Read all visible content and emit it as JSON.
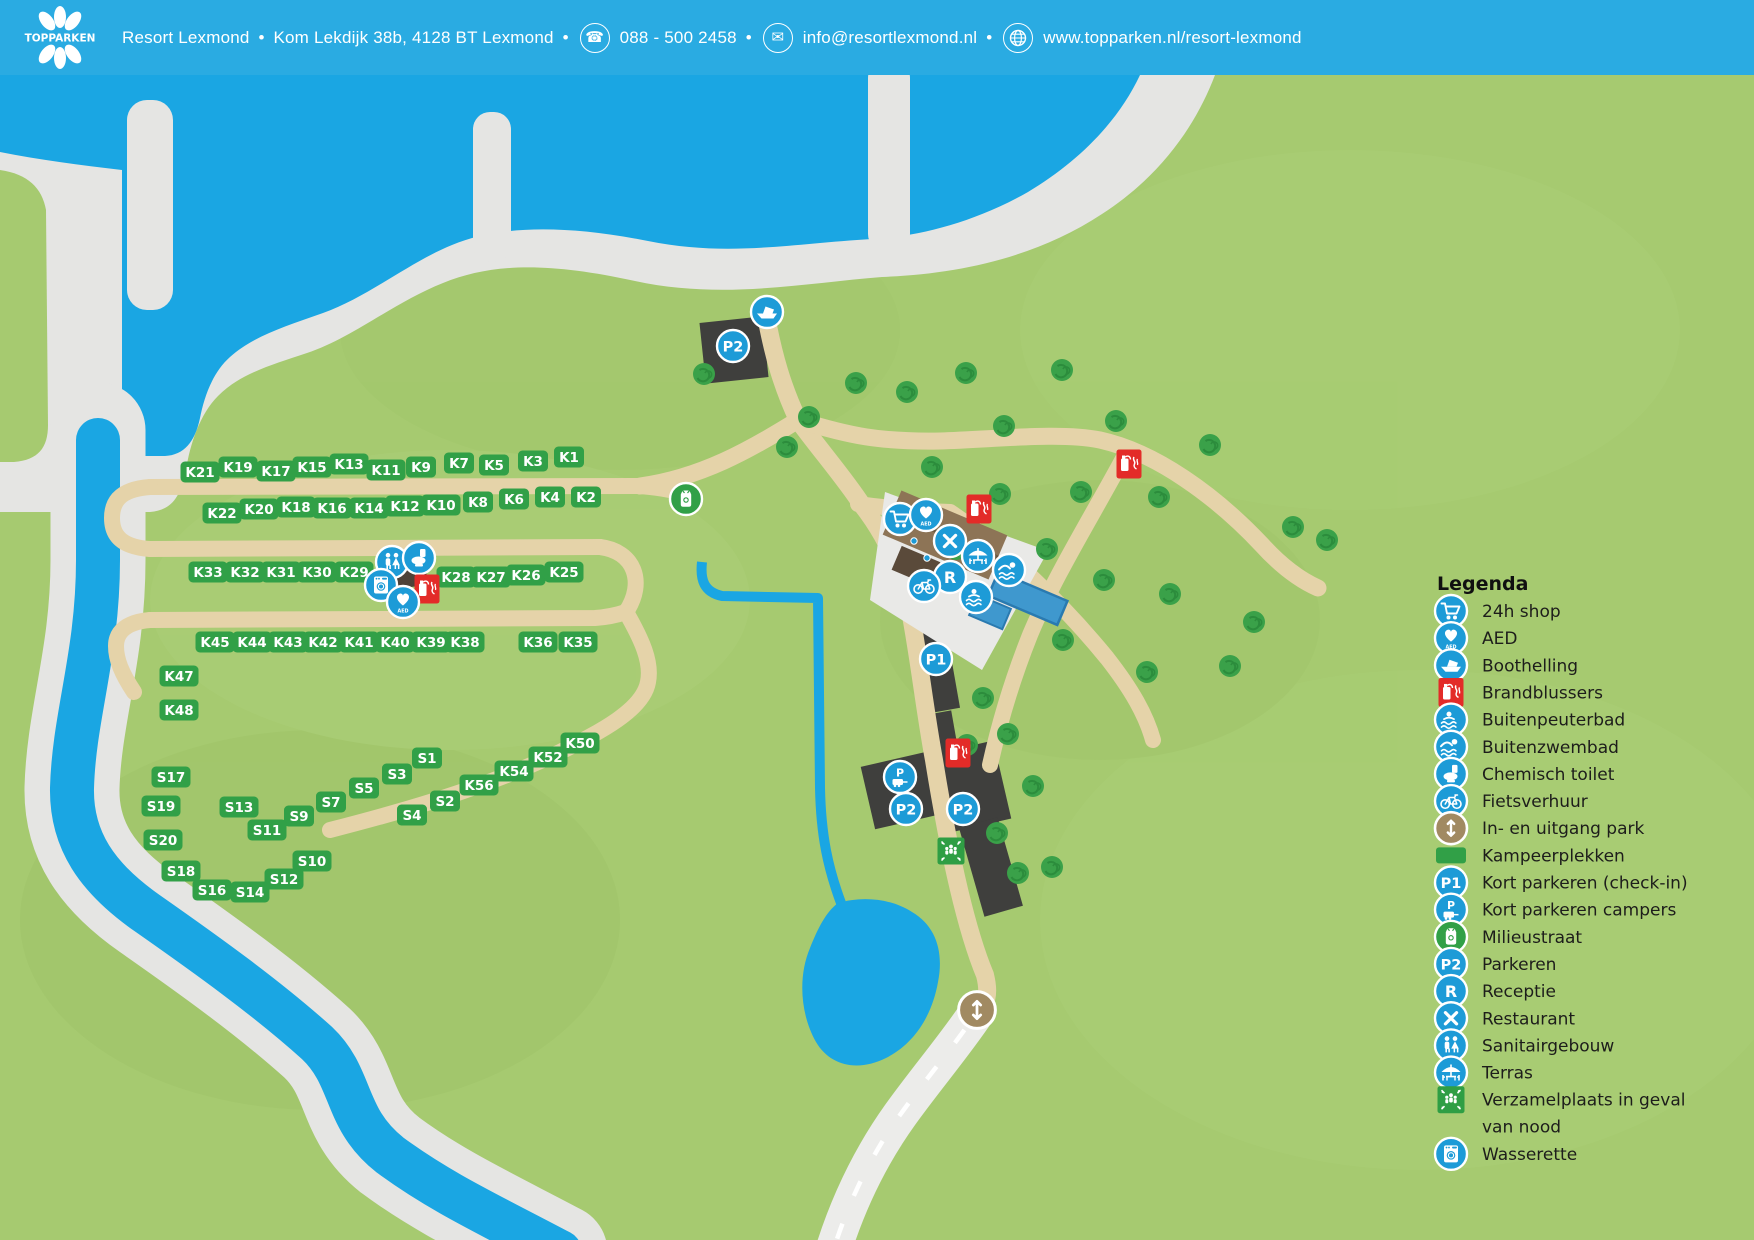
{
  "header": {
    "logo_text": "TOPPARKEN",
    "resort_name": "Resort Lexmond",
    "address": "Kom Lekdijk 38b, 4128 BT Lexmond",
    "separator": "•",
    "phone": "088 - 500 2458",
    "email": "info@resortlexmond.nl",
    "website": "www.topparken.nl/resort-lexmond",
    "glyphs": {
      "phone": "☎",
      "mail": "✉"
    }
  },
  "colors": {
    "header_bg": "#2aabe2",
    "grass": "#a6ca70",
    "water": "#1aa6e3",
    "sand": "#e5e5e3",
    "road": "#e5d3a9",
    "parking_dark": "#3f3f3d",
    "label_green": "#31a047",
    "icon_blue": "#1d9bd7",
    "icon_red": "#e32b28",
    "icon_green": "#31a047",
    "entrance_brown": "#a18a62",
    "plaza": "#e9e9e7",
    "building": "#8d7456",
    "pool": "#3f98ce",
    "white_road": "#ececea",
    "tree": "#3aa149"
  },
  "legend": {
    "title": "Legenda",
    "items": [
      {
        "icon": "shop",
        "label": "24h shop"
      },
      {
        "icon": "aed",
        "label": "AED"
      },
      {
        "icon": "boothelling",
        "label": "Boothelling"
      },
      {
        "icon": "brandblussers",
        "label": "Brandblussers"
      },
      {
        "icon": "peuterbad",
        "label": "Buitenpeuterbad"
      },
      {
        "icon": "zwembad",
        "label": "Buitenzwembad"
      },
      {
        "icon": "chemisch",
        "label": "Chemisch toilet"
      },
      {
        "icon": "fiets",
        "label": "Fietsverhuur"
      },
      {
        "icon": "entrance",
        "label": "In- en uitgang park"
      },
      {
        "icon": "kampeerplekken",
        "label": "Kampeerplekken"
      },
      {
        "icon": "p1",
        "label": "Kort parkeren (check-in)"
      },
      {
        "icon": "pcampers",
        "label": "Kort parkeren campers"
      },
      {
        "icon": "milieustraat",
        "label": "Milieustraat"
      },
      {
        "icon": "p2",
        "label": "Parkeren"
      },
      {
        "icon": "receptie",
        "label": "Receptie"
      },
      {
        "icon": "restaurant",
        "label": "Restaurant"
      },
      {
        "icon": "sanitair",
        "label": "Sanitairgebouw"
      },
      {
        "icon": "terras",
        "label": "Terras"
      },
      {
        "icon": "verzamel",
        "label": "Verzamelplaats in geval",
        "label2": "van nood"
      },
      {
        "icon": "wasserette",
        "label": "Wasserette"
      }
    ]
  },
  "map": {
    "site_labels": [
      {
        "id": "K21",
        "x": 200,
        "y": 472
      },
      {
        "id": "K19",
        "x": 238,
        "y": 467
      },
      {
        "id": "K17",
        "x": 276,
        "y": 471
      },
      {
        "id": "K15",
        "x": 312,
        "y": 467
      },
      {
        "id": "K13",
        "x": 349,
        "y": 464
      },
      {
        "id": "K11",
        "x": 386,
        "y": 470
      },
      {
        "id": "K9",
        "x": 421,
        "y": 467
      },
      {
        "id": "K7",
        "x": 459,
        "y": 463
      },
      {
        "id": "K5",
        "x": 494,
        "y": 465
      },
      {
        "id": "K3",
        "x": 533,
        "y": 461
      },
      {
        "id": "K1",
        "x": 569,
        "y": 457
      },
      {
        "id": "K22",
        "x": 222,
        "y": 513
      },
      {
        "id": "K20",
        "x": 259,
        "y": 509
      },
      {
        "id": "K18",
        "x": 296,
        "y": 507
      },
      {
        "id": "K16",
        "x": 332,
        "y": 508
      },
      {
        "id": "K14",
        "x": 369,
        "y": 508
      },
      {
        "id": "K12",
        "x": 405,
        "y": 506
      },
      {
        "id": "K10",
        "x": 441,
        "y": 505
      },
      {
        "id": "K8",
        "x": 478,
        "y": 502
      },
      {
        "id": "K6",
        "x": 514,
        "y": 499
      },
      {
        "id": "K4",
        "x": 550,
        "y": 497
      },
      {
        "id": "K2",
        "x": 586,
        "y": 497
      },
      {
        "id": "K33",
        "x": 208,
        "y": 572
      },
      {
        "id": "K32",
        "x": 245,
        "y": 572
      },
      {
        "id": "K31",
        "x": 281,
        "y": 572
      },
      {
        "id": "K30",
        "x": 317,
        "y": 572
      },
      {
        "id": "K29",
        "x": 354,
        "y": 572
      },
      {
        "id": "K28",
        "x": 456,
        "y": 577
      },
      {
        "id": "K27",
        "x": 491,
        "y": 577
      },
      {
        "id": "K26",
        "x": 526,
        "y": 575
      },
      {
        "id": "K25",
        "x": 564,
        "y": 572
      },
      {
        "id": "K45",
        "x": 215,
        "y": 642
      },
      {
        "id": "K44",
        "x": 252,
        "y": 642
      },
      {
        "id": "K43",
        "x": 288,
        "y": 642
      },
      {
        "id": "K42",
        "x": 323,
        "y": 642
      },
      {
        "id": "K41",
        "x": 359,
        "y": 642
      },
      {
        "id": "K40",
        "x": 395,
        "y": 642
      },
      {
        "id": "K39",
        "x": 431,
        "y": 642
      },
      {
        "id": "K38",
        "x": 465,
        "y": 642
      },
      {
        "id": "K36",
        "x": 538,
        "y": 642
      },
      {
        "id": "K35",
        "x": 578,
        "y": 642
      },
      {
        "id": "K47",
        "x": 179,
        "y": 676
      },
      {
        "id": "K48",
        "x": 179,
        "y": 710
      },
      {
        "id": "K50",
        "x": 580,
        "y": 743
      },
      {
        "id": "K52",
        "x": 548,
        "y": 757
      },
      {
        "id": "K54",
        "x": 514,
        "y": 771
      },
      {
        "id": "K56",
        "x": 479,
        "y": 785
      },
      {
        "id": "S1",
        "x": 427,
        "y": 758
      },
      {
        "id": "S3",
        "x": 397,
        "y": 774
      },
      {
        "id": "S5",
        "x": 364,
        "y": 788
      },
      {
        "id": "S7",
        "x": 331,
        "y": 802
      },
      {
        "id": "S9",
        "x": 299,
        "y": 816
      },
      {
        "id": "S11",
        "x": 267,
        "y": 830
      },
      {
        "id": "S13",
        "x": 239,
        "y": 807
      },
      {
        "id": "S17",
        "x": 171,
        "y": 777
      },
      {
        "id": "S19",
        "x": 161,
        "y": 806
      },
      {
        "id": "S20",
        "x": 163,
        "y": 840
      },
      {
        "id": "S18",
        "x": 181,
        "y": 871
      },
      {
        "id": "S16",
        "x": 212,
        "y": 890
      },
      {
        "id": "S14",
        "x": 250,
        "y": 892
      },
      {
        "id": "S12",
        "x": 284,
        "y": 879
      },
      {
        "id": "S10",
        "x": 312,
        "y": 861
      },
      {
        "id": "S4",
        "x": 412,
        "y": 815
      },
      {
        "id": "S2",
        "x": 445,
        "y": 801
      }
    ],
    "icons": [
      {
        "type": "p2",
        "x": 733,
        "y": 346
      },
      {
        "type": "boothelling",
        "x": 767,
        "y": 312
      },
      {
        "type": "milieustraat",
        "x": 686,
        "y": 499
      },
      {
        "type": "sanitair",
        "x": 392,
        "y": 562
      },
      {
        "type": "chemisch",
        "x": 419,
        "y": 558
      },
      {
        "type": "wasserette",
        "x": 381,
        "y": 585
      },
      {
        "type": "brandblussers",
        "x": 427,
        "y": 589
      },
      {
        "type": "aed",
        "x": 403,
        "y": 602
      },
      {
        "type": "shop",
        "x": 900,
        "y": 519
      },
      {
        "type": "aed",
        "x": 926,
        "y": 515
      },
      {
        "type": "brandblussers",
        "x": 979,
        "y": 509
      },
      {
        "type": "restaurant",
        "x": 950,
        "y": 541
      },
      {
        "type": "terras",
        "x": 978,
        "y": 556
      },
      {
        "type": "receptie",
        "x": 950,
        "y": 577
      },
      {
        "type": "fiets",
        "x": 924,
        "y": 586
      },
      {
        "type": "zwembad",
        "x": 1009,
        "y": 570
      },
      {
        "type": "peuterbad",
        "x": 976,
        "y": 597
      },
      {
        "type": "p1",
        "x": 936,
        "y": 659
      },
      {
        "type": "pcampers",
        "x": 900,
        "y": 777
      },
      {
        "type": "p2",
        "x": 906,
        "y": 809
      },
      {
        "type": "p2",
        "x": 963,
        "y": 809
      },
      {
        "type": "brandblussers",
        "x": 958,
        "y": 753
      },
      {
        "type": "verzamel",
        "x": 951,
        "y": 851
      },
      {
        "type": "brandblussers",
        "x": 1129,
        "y": 464
      },
      {
        "type": "entrance",
        "x": 977,
        "y": 1010,
        "scale": 1.15
      }
    ],
    "trees": [
      [
        704,
        374
      ],
      [
        809,
        417
      ],
      [
        856,
        383
      ],
      [
        907,
        392
      ],
      [
        966,
        373
      ],
      [
        787,
        447
      ],
      [
        932,
        467
      ],
      [
        1004,
        426
      ],
      [
        1062,
        370
      ],
      [
        1116,
        421
      ],
      [
        1081,
        492
      ],
      [
        1000,
        494
      ],
      [
        1159,
        497
      ],
      [
        1210,
        445
      ],
      [
        956,
        549
      ],
      [
        1047,
        549
      ],
      [
        1104,
        580
      ],
      [
        1170,
        594
      ],
      [
        1254,
        622
      ],
      [
        1063,
        640
      ],
      [
        1147,
        672
      ],
      [
        1230,
        666
      ],
      [
        983,
        698
      ],
      [
        967,
        745
      ],
      [
        1008,
        734
      ],
      [
        1033,
        786
      ],
      [
        997,
        833
      ],
      [
        1052,
        867
      ],
      [
        1018,
        873
      ],
      [
        1293,
        527
      ],
      [
        1327,
        540
      ]
    ]
  }
}
